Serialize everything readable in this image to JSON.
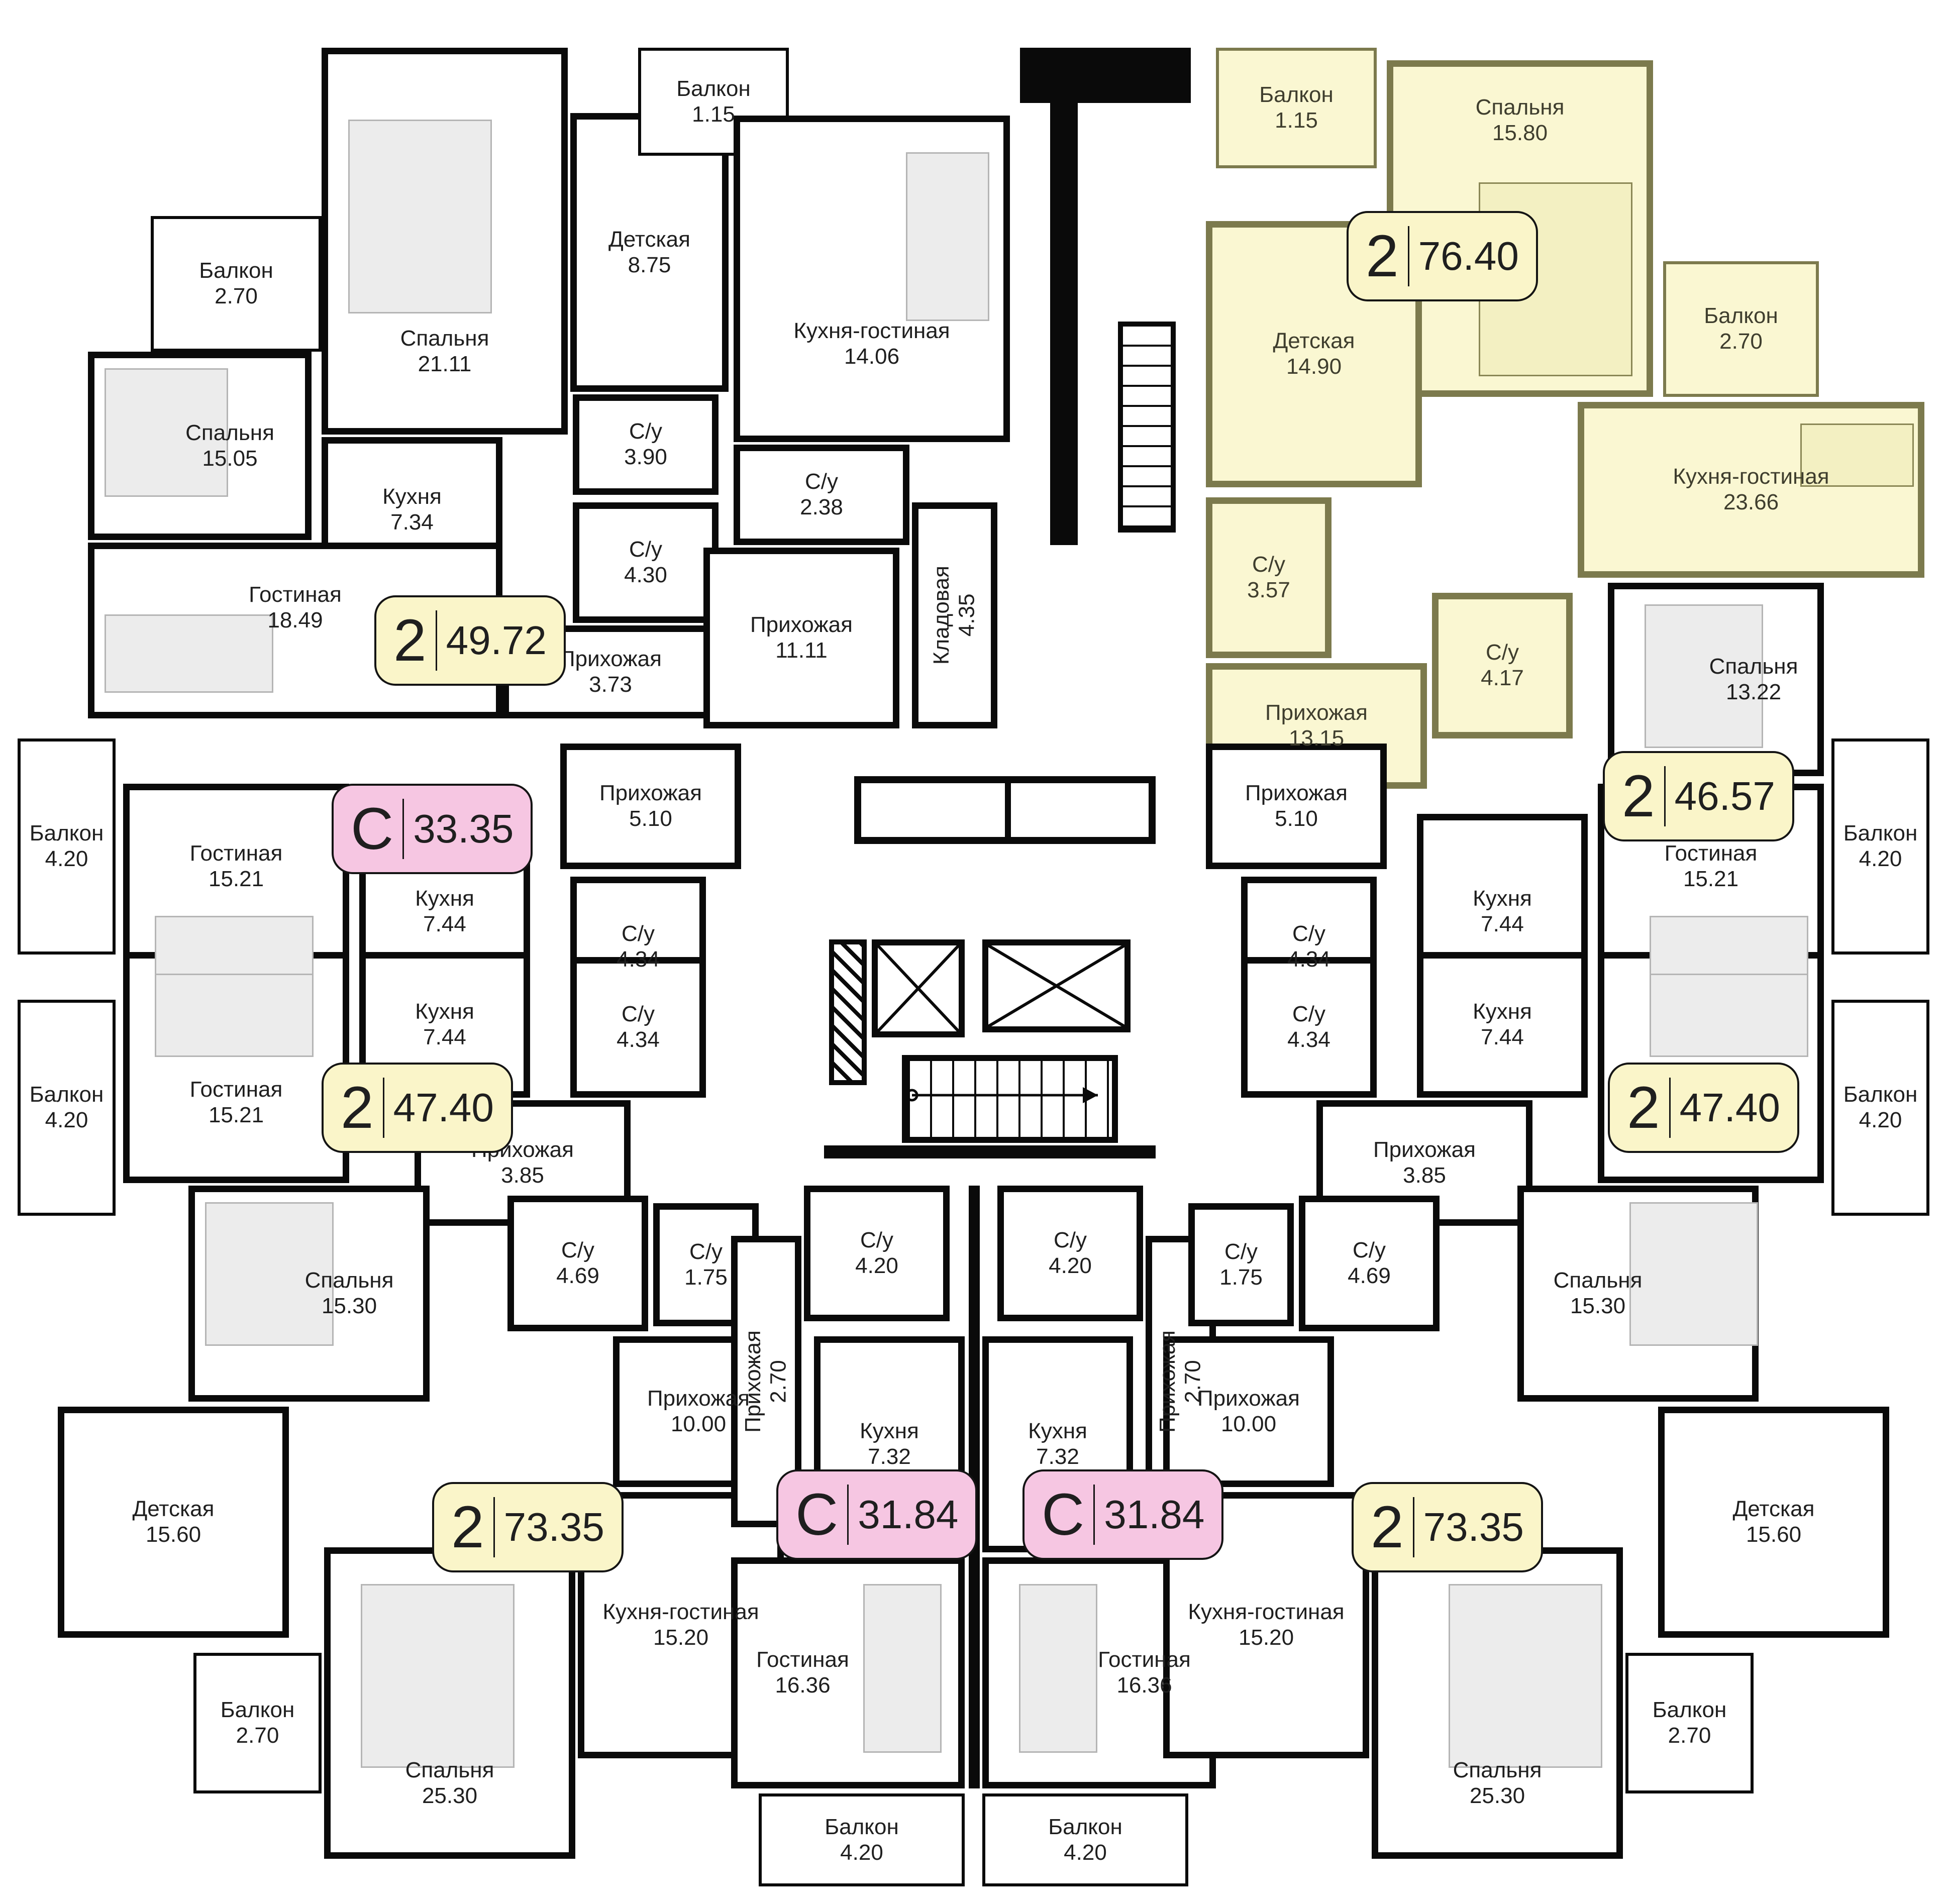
{
  "colors": {
    "wall": "#0a0a0a",
    "highlight_wall": "#7C7A4D",
    "highlight_fill": "#FAF7D2",
    "badge_yellow": "#FAF5C9",
    "badge_pink": "#F6C6E2",
    "room_fill": "#FFFFFF",
    "text": "#1F1F1F"
  },
  "icons": {
    "elevator": "crossed-box",
    "stairs": "striped-strip-with-arrow",
    "wardrobe": "hatched-strip"
  },
  "apartments": [
    {
      "id": "top-left",
      "badge": {
        "type": "2",
        "area": "49.72"
      },
      "highlighted": false,
      "rooms": [
        {
          "name": "Балкон",
          "area": "2.70"
        },
        {
          "name": "Спальня",
          "area": "21.11"
        },
        {
          "name": "Детская",
          "area": "8.75"
        },
        {
          "name": "Спальня",
          "area": "15.05"
        },
        {
          "name": "Кухня",
          "area": "7.34"
        },
        {
          "name": "С/у",
          "area": "3.90"
        },
        {
          "name": "С/у",
          "area": "4.30"
        },
        {
          "name": "Гостиная",
          "area": "18.49"
        },
        {
          "name": "Прихожая",
          "area": "3.73"
        }
      ]
    },
    {
      "id": "top-middle",
      "badge": null,
      "highlighted": false,
      "rooms": [
        {
          "name": "Балкон",
          "area": "1.15"
        },
        {
          "name": "Кухня-гостиная",
          "area": "14.06"
        },
        {
          "name": "С/у",
          "area": "2.38"
        },
        {
          "name": "Прихожая",
          "area": "11.11"
        },
        {
          "name": "Кладовая",
          "area": "4.35"
        }
      ]
    },
    {
      "id": "top-right-highlighted",
      "badge": {
        "type": "2",
        "area": "76.40"
      },
      "highlighted": true,
      "rooms": [
        {
          "name": "Балкон",
          "area": "1.15"
        },
        {
          "name": "Спальня",
          "area": "15.80"
        },
        {
          "name": "Балкон",
          "area": "2.70"
        },
        {
          "name": "Детская",
          "area": "14.90"
        },
        {
          "name": "С/у",
          "area": "3.57"
        },
        {
          "name": "Кухня-гостиная",
          "area": "23.66"
        },
        {
          "name": "Прихожая",
          "area": "13.15"
        },
        {
          "name": "С/у",
          "area": "4.17"
        }
      ]
    },
    {
      "id": "right-row-1",
      "badge": {
        "type": "2",
        "area": "46.57"
      },
      "highlighted": false,
      "rooms": [
        {
          "name": "Спальня",
          "area": "13.22"
        },
        {
          "name": "Прихожая",
          "area": "5.10"
        },
        {
          "name": "С/у",
          "area": "4.34"
        },
        {
          "name": "Кухня",
          "area": "7.44"
        },
        {
          "name": "Гостиная",
          "area": "15.21"
        },
        {
          "name": "Балкон",
          "area": "4.20"
        }
      ]
    },
    {
      "id": "right-row-2",
      "badge": {
        "type": "2",
        "area": "47.40"
      },
      "highlighted": false,
      "rooms": [
        {
          "name": "С/у",
          "area": "4.34"
        },
        {
          "name": "Кухня",
          "area": "7.44"
        },
        {
          "name": "Гостиная",
          "area": "15.21"
        },
        {
          "name": "Прихожая",
          "area": "3.85"
        },
        {
          "name": "Балкон",
          "area": "4.20"
        }
      ]
    },
    {
      "id": "left-row-1",
      "badge": {
        "type": "С",
        "area": "33.35"
      },
      "highlighted": false,
      "rooms": [
        {
          "name": "Балкон",
          "area": "4.20"
        },
        {
          "name": "Гостиная",
          "area": "15.21"
        },
        {
          "name": "Кухня",
          "area": "7.44"
        },
        {
          "name": "С/у",
          "area": "4.34"
        },
        {
          "name": "Прихожая",
          "area": "5.10"
        }
      ]
    },
    {
      "id": "left-row-2",
      "badge": {
        "type": "2",
        "area": "47.40"
      },
      "highlighted": false,
      "rooms": [
        {
          "name": "Балкон",
          "area": "4.20"
        },
        {
          "name": "Гостиная",
          "area": "15.21"
        },
        {
          "name": "Кухня",
          "area": "7.44"
        },
        {
          "name": "С/у",
          "area": "4.34"
        },
        {
          "name": "Прихожая",
          "area": "3.85"
        }
      ]
    },
    {
      "id": "bottom-left",
      "badge": {
        "type": "2",
        "area": "73.35"
      },
      "highlighted": false,
      "rooms": [
        {
          "name": "Спальня",
          "area": "15.30"
        },
        {
          "name": "С/у",
          "area": "4.69"
        },
        {
          "name": "С/у",
          "area": "1.75"
        },
        {
          "name": "Прихожая",
          "area": "10.00"
        },
        {
          "name": "Детская",
          "area": "15.60"
        },
        {
          "name": "Кухня-гостиная",
          "area": "15.20"
        },
        {
          "name": "Спальня",
          "area": "25.30"
        },
        {
          "name": "Балкон",
          "area": "2.70"
        }
      ]
    },
    {
      "id": "bottom-middle-left",
      "badge": {
        "type": "С",
        "area": "31.84"
      },
      "highlighted": false,
      "rooms": [
        {
          "name": "С/у",
          "area": "4.20"
        },
        {
          "name": "Прихожая",
          "area": "2.70"
        },
        {
          "name": "Кухня",
          "area": "7.32"
        },
        {
          "name": "Гостиная",
          "area": "16.36"
        },
        {
          "name": "Балкон",
          "area": "4.20"
        }
      ]
    },
    {
      "id": "bottom-middle-right",
      "badge": {
        "type": "С",
        "area": "31.84"
      },
      "highlighted": false,
      "rooms": [
        {
          "name": "С/у",
          "area": "4.20"
        },
        {
          "name": "Прихожая",
          "area": "2.70"
        },
        {
          "name": "Кухня",
          "area": "7.32"
        },
        {
          "name": "Гостиная",
          "area": "16.36"
        },
        {
          "name": "Балкон",
          "area": "4.20"
        }
      ]
    },
    {
      "id": "bottom-right",
      "badge": {
        "type": "2",
        "area": "73.35"
      },
      "highlighted": false,
      "rooms": [
        {
          "name": "Спальня",
          "area": "15.30"
        },
        {
          "name": "С/у",
          "area": "4.69"
        },
        {
          "name": "С/у",
          "area": "1.75"
        },
        {
          "name": "Прихожая",
          "area": "10.00"
        },
        {
          "name": "Детская",
          "area": "15.60"
        },
        {
          "name": "Кухня-гостиная",
          "area": "15.20"
        },
        {
          "name": "Спальня",
          "area": "25.30"
        },
        {
          "name": "Балкон",
          "area": "2.70"
        }
      ]
    }
  ]
}
